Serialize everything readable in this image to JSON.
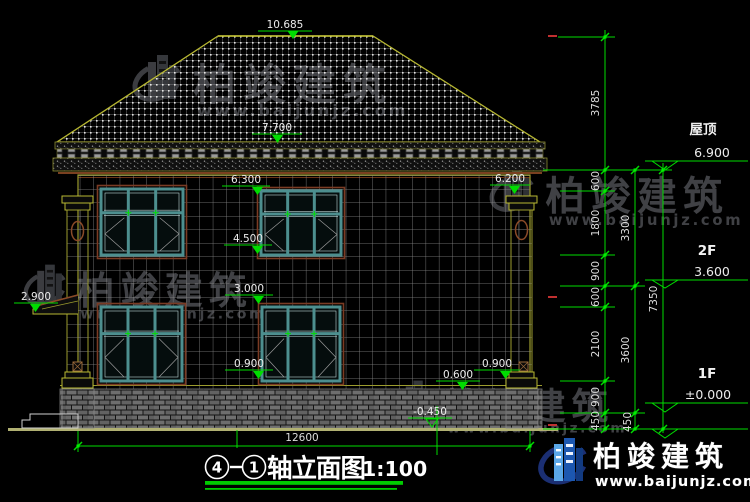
{
  "title": {
    "axis_start": "4",
    "axis_end": "1",
    "name": "轴立面图",
    "scale": "1:100"
  },
  "elevation_markers": {
    "ridge": "10.685",
    "eave": "7.700",
    "wall_top_left": "6.300",
    "wall_top_right": "6.200",
    "sill_2f": "4.500",
    "lintel_1f": "3.000",
    "awning": "2.900",
    "sill_1f_left": "0.900",
    "sill_1f_right": "0.900",
    "base_top": "0.600",
    "ground": "-0.450"
  },
  "levels": {
    "roof_label": "屋顶",
    "roof_value": "6.900",
    "f2_label": "2F",
    "f2_value": "3.600",
    "f1_label": "1F",
    "f1_value": "±0.000"
  },
  "dimensions": {
    "bottom_width": "12600",
    "right_chain_inner": [
      "3785",
      "600",
      "1800",
      "900",
      "600",
      "2100",
      "900",
      "450"
    ],
    "right_chain_middle": [
      "3300",
      "3600",
      "450"
    ],
    "right_chain_outer": [
      "7350"
    ]
  },
  "watermark": {
    "brand": "柏竣建筑",
    "url": "www.baijunjz.com"
  },
  "logo": {
    "brand": "柏竣建筑",
    "url": "www.baijunjz.com"
  },
  "colors": {
    "dimension_green": "#00dd00",
    "outline_olive": "#9c9c2e",
    "trim_brown": "#7a4020",
    "window_teal": "#4d8f8f",
    "logo_blue": "#1c57b0"
  }
}
